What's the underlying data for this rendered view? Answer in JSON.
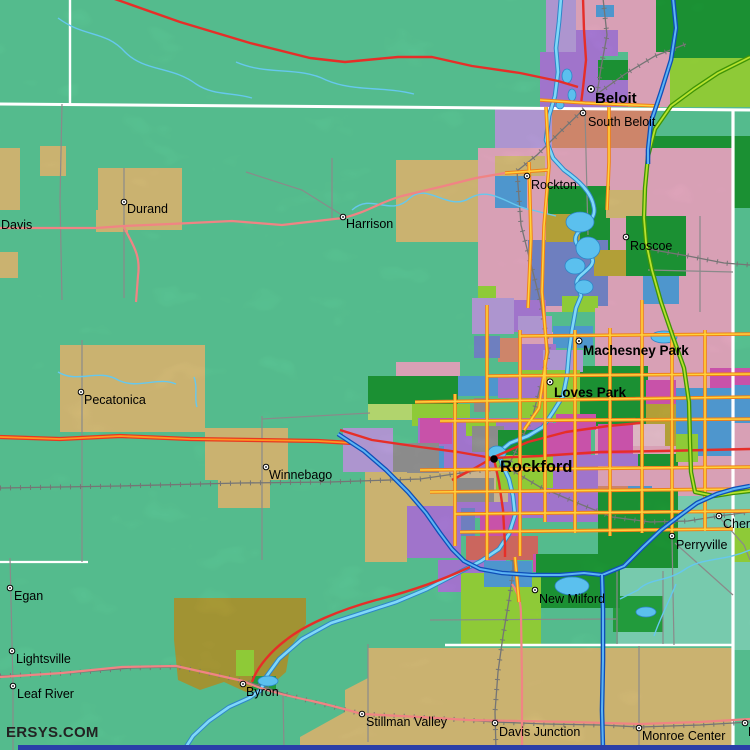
{
  "map": {
    "watermark": "ERSYS.COM",
    "places": {
      "beloit": {
        "name": "Beloit",
        "type": "city"
      },
      "south_beloit": {
        "name": "South Beloit",
        "type": "town"
      },
      "rockton": {
        "name": "Rockton",
        "type": "town"
      },
      "roscoe": {
        "name": "Roscoe",
        "type": "town"
      },
      "machesney_park": {
        "name": "Machesney Park",
        "type": "city"
      },
      "loves_park": {
        "name": "Loves Park",
        "type": "city"
      },
      "rockford": {
        "name": "Rockford",
        "type": "major-city"
      },
      "davis": {
        "name": "Davis",
        "type": "town"
      },
      "durand": {
        "name": "Durand",
        "type": "town"
      },
      "harrison": {
        "name": "Harrison",
        "type": "town"
      },
      "pecatonica": {
        "name": "Pecatonica",
        "type": "town"
      },
      "winnebago": {
        "name": "Winnebago",
        "type": "town"
      },
      "egan": {
        "name": "Egan",
        "type": "town"
      },
      "lightsville": {
        "name": "Lightsville",
        "type": "town"
      },
      "leaf_river": {
        "name": "Leaf River",
        "type": "town"
      },
      "byron": {
        "name": "Byron",
        "type": "town"
      },
      "stillman_valley": {
        "name": "Stillman Valley",
        "type": "town"
      },
      "davis_junction": {
        "name": "Davis Junction",
        "type": "town"
      },
      "monroe_center": {
        "name": "Monroe Center",
        "type": "town"
      },
      "new_milford": {
        "name": "New Milford",
        "type": "town"
      },
      "perryville": {
        "name": "Perryville",
        "type": "town"
      },
      "cherry": {
        "name": "Cherry",
        "type": "town"
      },
      "f_edge": {
        "name": "F",
        "type": "town"
      }
    },
    "palette": {
      "land": "#5fd29e",
      "land_se": "#86e2c2",
      "farm_tan": "#e2c77e",
      "farm_olive": "#b5a53a",
      "tract_pink": "#f2b3cb",
      "tract_magenta": "#e05cbe",
      "tract_purple": "#b382e4",
      "tract_lavender": "#c2a7e8",
      "tract_periwinkle": "#7b8fd6",
      "tract_skyblue": "#58a8e6",
      "tract_green_dark": "#1fa23a",
      "tract_green_mid": "#27ae44",
      "tract_yellowgreen": "#9fe23e",
      "tract_salmon": "#e69577",
      "tract_gray": "#9c9c9c",
      "tract_tan_light": "#e0c9a2",
      "tract_khaki": "#c8b23e",
      "tract_red": "#e3736a",
      "road_freeway_blue": "#5cb4f4",
      "road_freeway_casing": "#0f4fb8",
      "road_tollway_green": "#b8e22e",
      "road_tollway_casing": "#3f9406",
      "road_major_yellow": "#ffd23c",
      "road_major_casing": "#f08018",
      "road_us_orange": "#ff9620",
      "road_us_casing": "#e83820",
      "road_highway_red": "#e62e28",
      "road_minor_pink": "#f08484",
      "road_local_gray": "#8a8a8a",
      "water": "#5bc0ee",
      "boundary_white": "#ffffff",
      "bottom_bar_blue": "#2a3fa8"
    }
  }
}
